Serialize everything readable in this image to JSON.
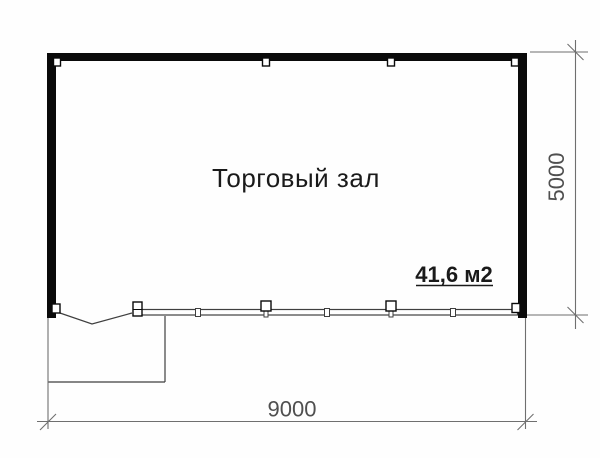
{
  "plan": {
    "room_label": "Торговый зал",
    "area_label": "41,6 м2"
  },
  "dimensions": {
    "width_mm": "9000",
    "height_mm": "5000"
  },
  "colors": {
    "background": "#fefefe",
    "wall": "#0a0a0a",
    "thin_line": "#3f3f3f",
    "dimension_line": "#6f6f6f",
    "dimension_text": "#4f4f4f",
    "label_text": "#1a1a1a"
  }
}
